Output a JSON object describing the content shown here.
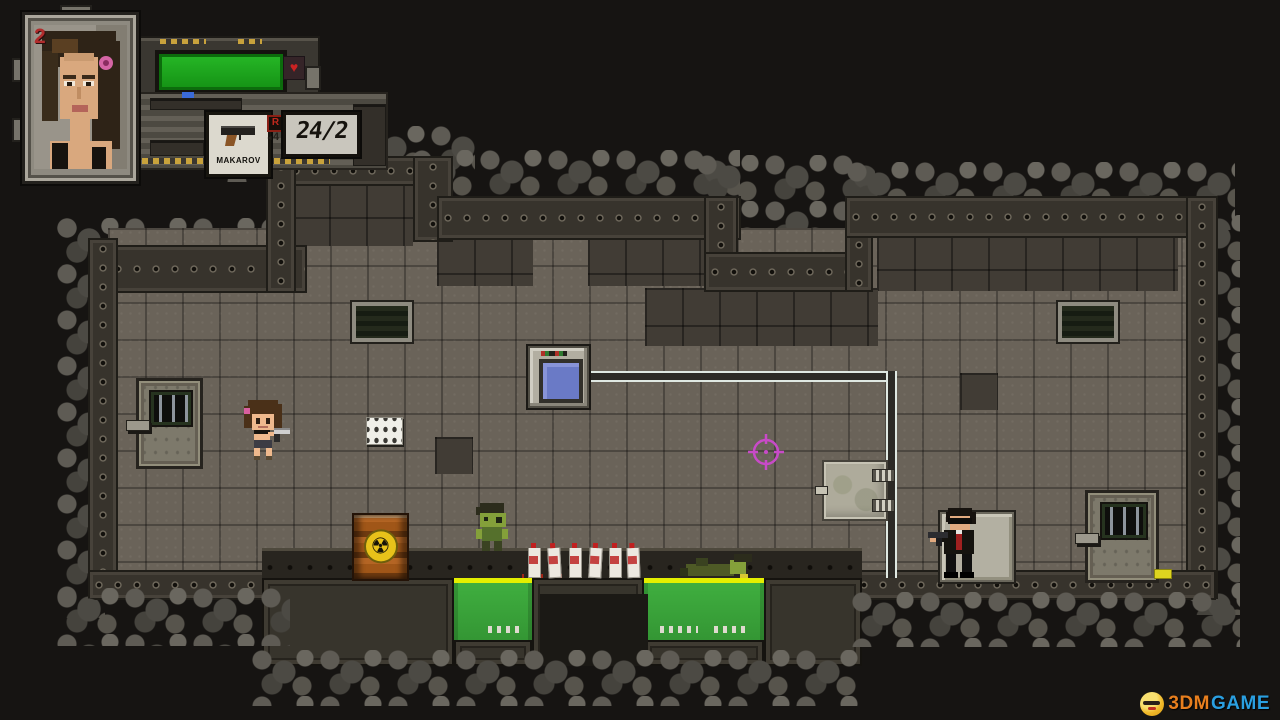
{
  "hud": {
    "lives": "2",
    "heart_icon": "♥",
    "health": {
      "percent": 100
    },
    "weapon": {
      "name": "MAKAROV",
      "reload_key": "R",
      "mags": "4",
      "arrow_icon": "◄",
      "ammo": "24/2"
    }
  },
  "level": {
    "radiation_icon": "☢"
  },
  "watermark": {
    "brand_left": "3DM",
    "brand_right": "GAME"
  },
  "colors": {
    "health_green": "#1fae1f",
    "pool_green": "#3aa33a",
    "pool_edge_yellow": "#e4ef00",
    "crosshair_magenta": "#c84ac8",
    "hud_red": "#b12c2c",
    "watermark_orange": "#e87f1e",
    "watermark_blue": "#2a9fe0"
  }
}
